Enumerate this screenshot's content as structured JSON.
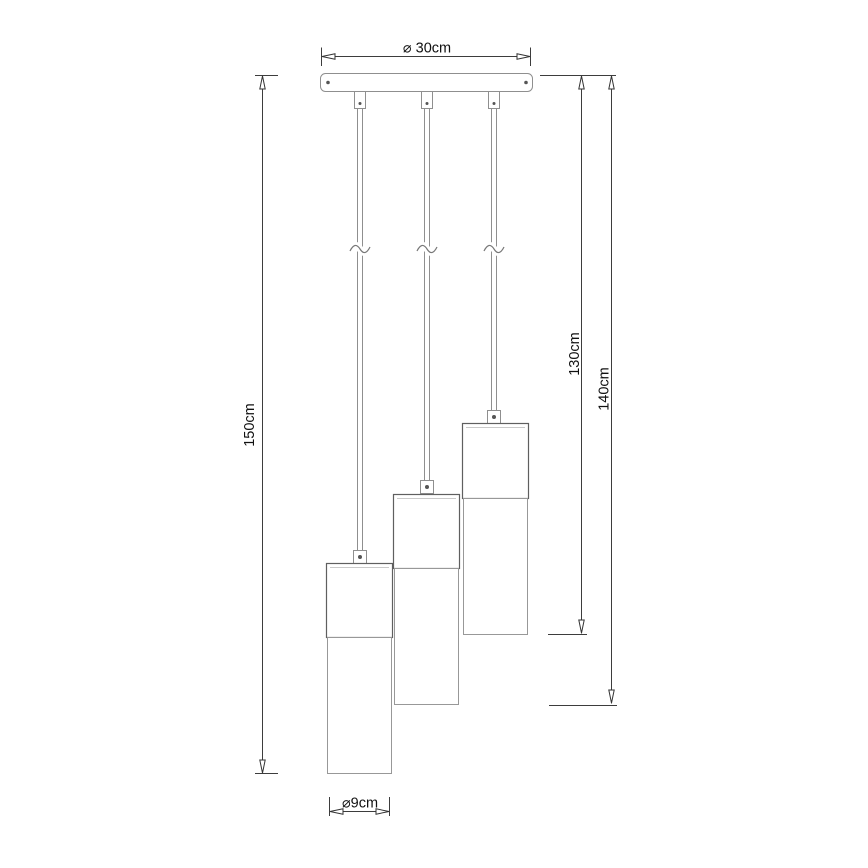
{
  "drawing": {
    "labels": {
      "canopy_diameter": "⌀ 30cm",
      "total_drop": "150cm",
      "drop_short": "130cm",
      "drop_middle": "140cm",
      "shade_diameter": "⌀9cm"
    },
    "colors": {
      "background": "#ffffff",
      "fixture_line": "#8f8f8f",
      "shade_upper_line": "#5f5f5f",
      "dimension_line": "#3d3d3d",
      "text": "#111111"
    },
    "pendant_count": 3
  }
}
